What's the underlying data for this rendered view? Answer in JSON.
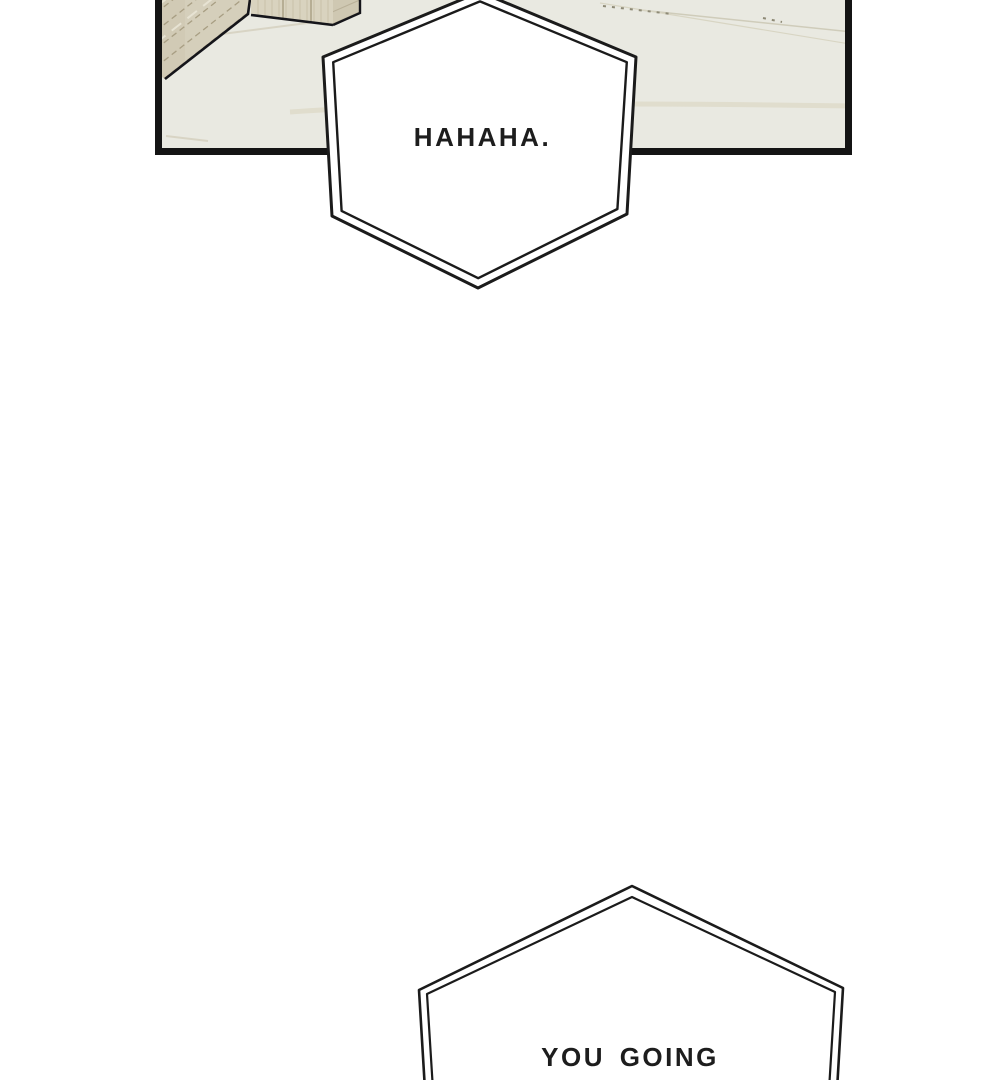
{
  "page": {
    "type": "webtoon comic page",
    "background_color": "#ffffff"
  },
  "panel": {
    "description": "Overhead interior view of a room corner: wooden wall panel and wooden cabinet on a pale floor with faint seam lines",
    "border_color": "#141414",
    "floor_color": "#e9e9e1",
    "wood_wall_color": "#d5cfbb",
    "wood_cabinet_front_color": "#d9d3bf",
    "wood_cabinet_side_color": "#cfc8b2"
  },
  "speech_bubbles": [
    {
      "shape": "double-outlined hexagon",
      "text": "HAHAHA.",
      "position": "overlapping bottom edge of top panel"
    },
    {
      "shape": "double-outlined hexagon",
      "text": "YOU GOING",
      "position": "bottom of page, cut off by viewport"
    }
  ]
}
